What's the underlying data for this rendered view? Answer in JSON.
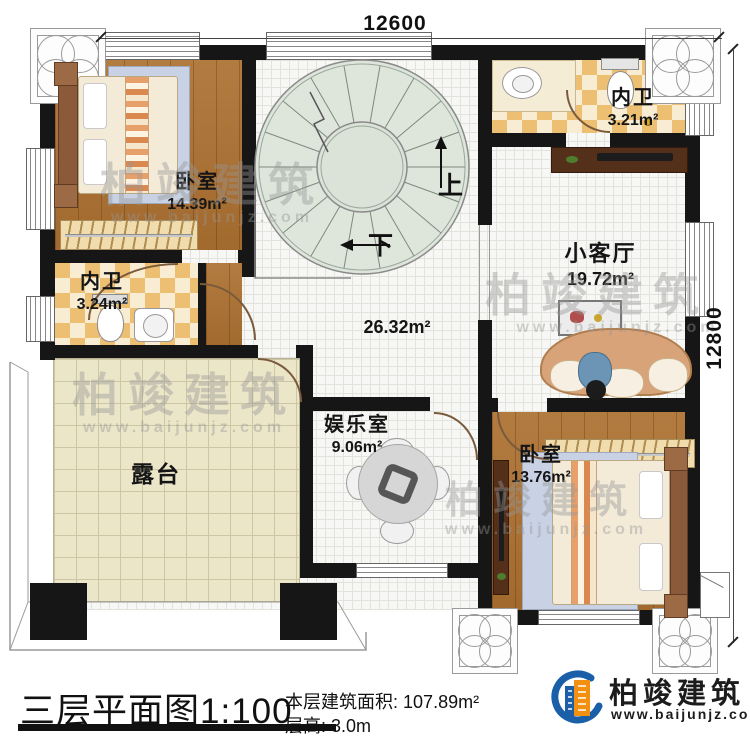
{
  "dimensions": {
    "top": "12600",
    "right": "12800"
  },
  "rooms": {
    "bedroom_tl": {
      "name": "卧室",
      "area": "14.39m²"
    },
    "bath_tl": {
      "name": "内卫",
      "area": "3.24m²"
    },
    "bath_tr": {
      "name": "内卫",
      "area": "3.21m²"
    },
    "living": {
      "name": "小客厅",
      "area": "19.72m²"
    },
    "hall": {
      "area": "26.32m²"
    },
    "entertainment": {
      "name": "娱乐室",
      "area": "9.06m²"
    },
    "bedroom_br": {
      "name": "卧室",
      "area": "13.76m²"
    },
    "terrace": {
      "name": "露台"
    }
  },
  "stairs": {
    "up": "上",
    "down": "下"
  },
  "titleblock": {
    "title": "三层平面图",
    "scale": "1:100",
    "area_label": "本层建筑面积:",
    "area_value": "107.89m²",
    "height_label": "层高:",
    "height_value": "3.0m"
  },
  "brand": {
    "name": "柏竣建筑",
    "url": "www.baijunjz.com"
  },
  "watermark": {
    "name": "柏竣建筑",
    "url": "www.baijunjz.com"
  }
}
